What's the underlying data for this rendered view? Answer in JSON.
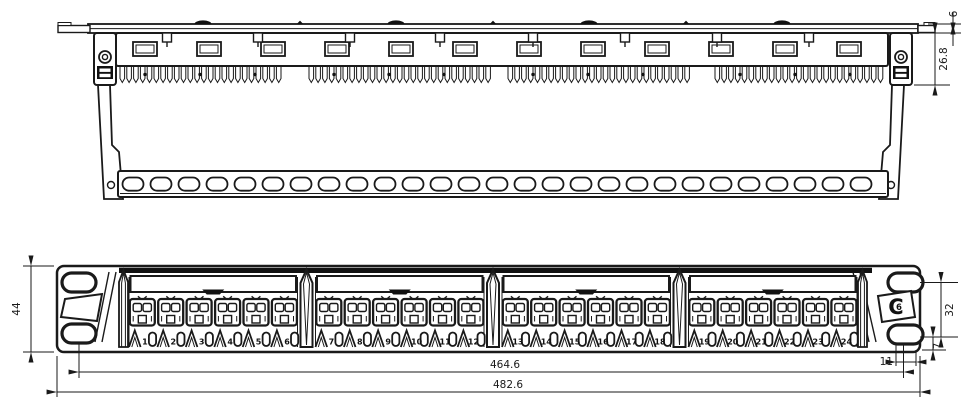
{
  "meta": {
    "background": "#ffffff",
    "line_color": "#1a1a1a",
    "dark_fill": "#111111"
  },
  "dimensions": {
    "flange_height": "6",
    "rear_depth": "26.8",
    "panel_height": "44",
    "ear_hole_spacing": "32",
    "hole_to_bottom_edge": "7",
    "hole_to_side_edge": "11",
    "mounting_hole_centers": "464.6",
    "overall_width": "482.6"
  },
  "ports": {
    "count": 24,
    "groups": 4,
    "per_group": 6,
    "numbers": [
      "1",
      "2",
      "3",
      "4",
      "5",
      "6",
      "7",
      "8",
      "9",
      "10",
      "11",
      "12",
      "13",
      "14",
      "15",
      "16",
      "17",
      "18",
      "19",
      "20",
      "21",
      "22",
      "23",
      "24"
    ]
  },
  "category_mark": {
    "outer": "C",
    "inner": "6"
  }
}
